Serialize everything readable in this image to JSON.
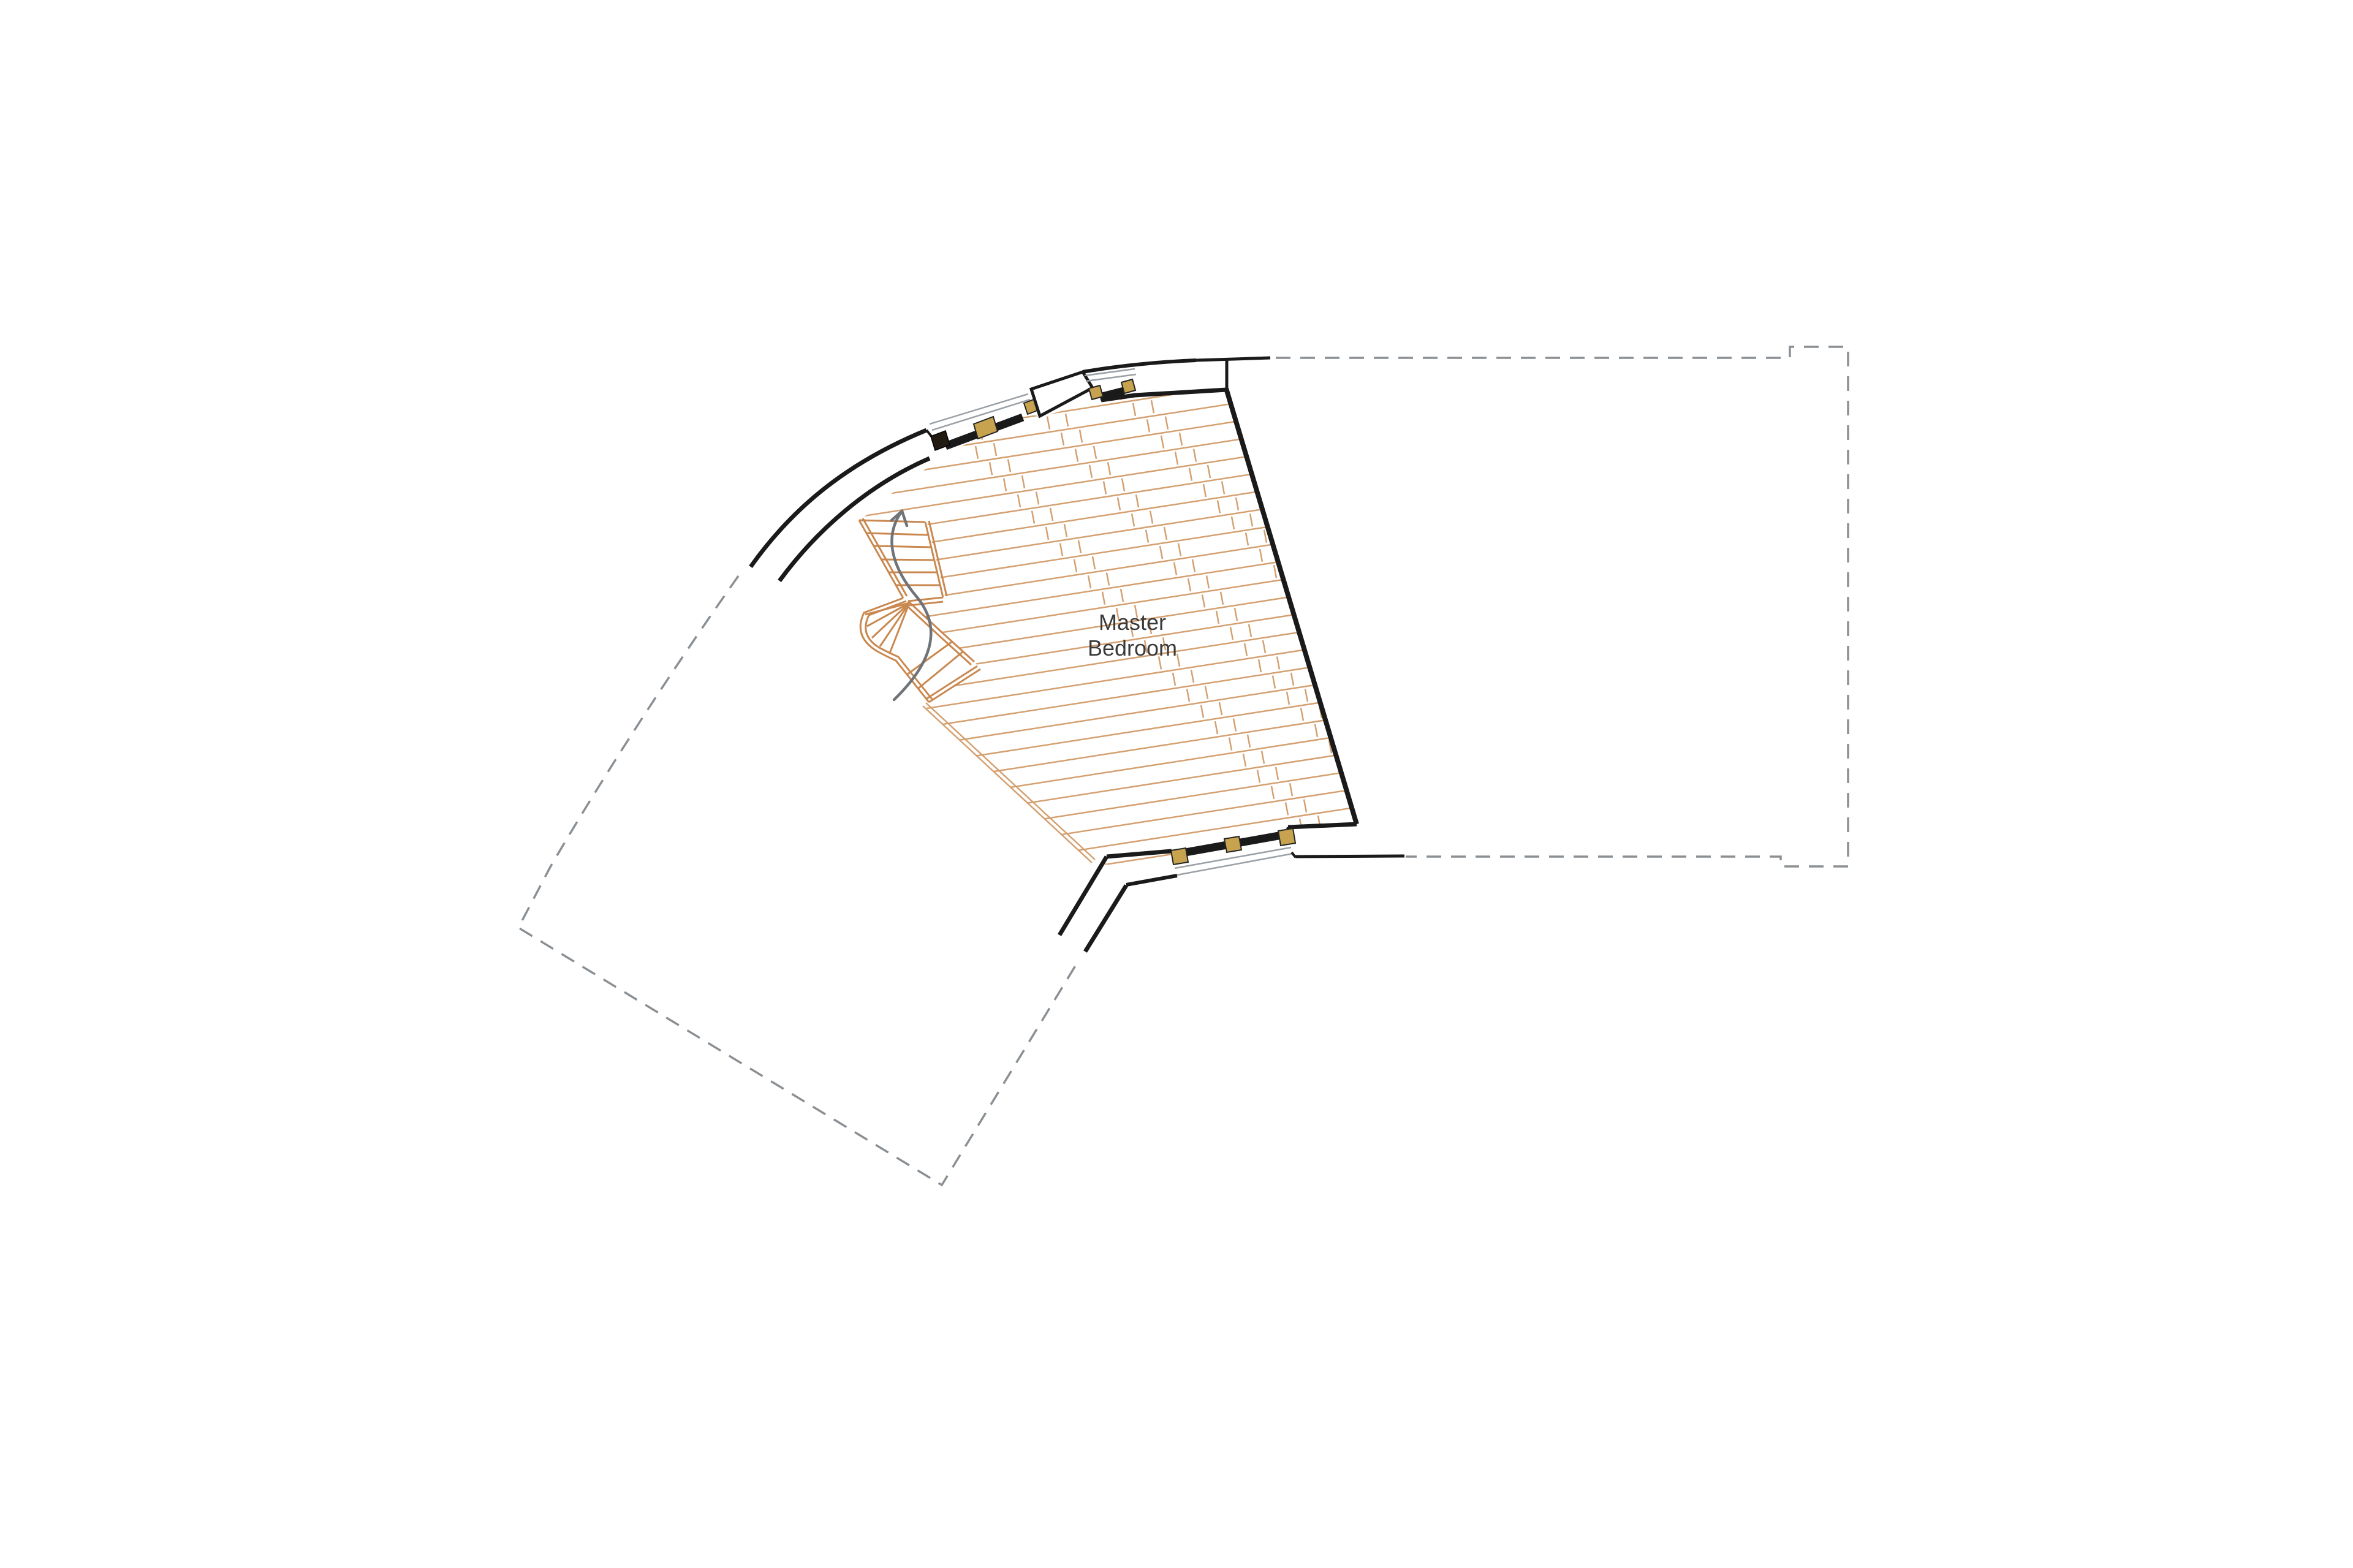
{
  "room": {
    "label_line1": "Master",
    "label_line2": "Bedroom"
  },
  "palette": {
    "wall": "#1a1a1a",
    "hatch": "#d4a070",
    "stair": "#c9884f",
    "window_frame_block": "#c7a34f",
    "glazing": "#9aa0a5",
    "dashed_outline": "#8a8f94",
    "arrow": "#6f7479",
    "text": "#3a3a3a",
    "background": "#ffffff"
  }
}
